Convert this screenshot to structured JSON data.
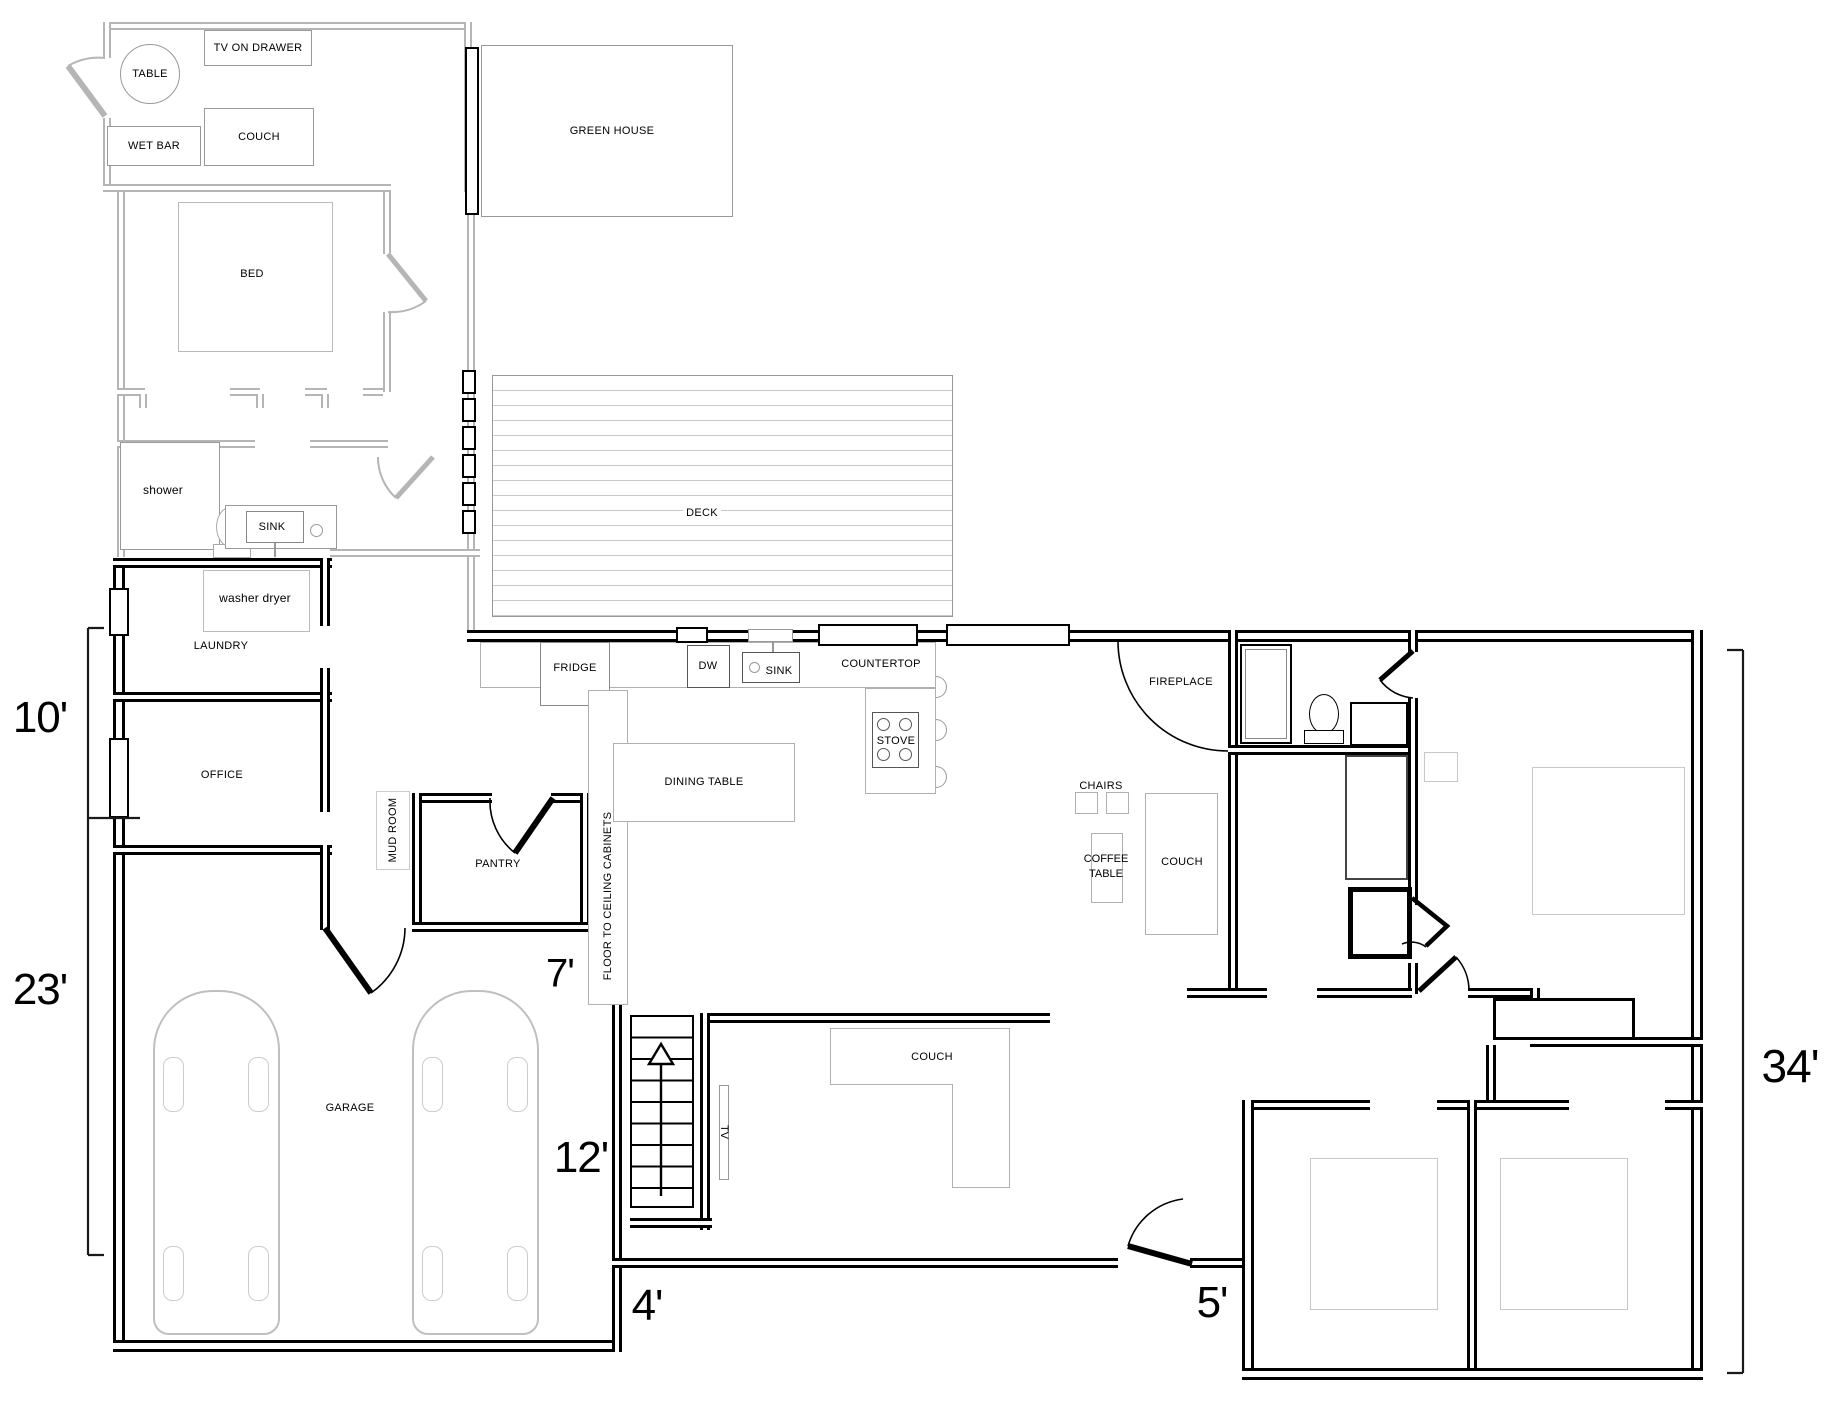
{
  "meta": {
    "type": "architectural floor plan"
  },
  "colors": {
    "wall_black": "#000000",
    "wall_gray": "#b5b5b5",
    "furniture_outline": "#b0b0b0",
    "bed_outline": "#c8c8c8",
    "deck_plank_line": "#c9c9c9",
    "background": "#ffffff"
  },
  "labels": {
    "tv_on_drawer": "TV ON DRAWER",
    "table": "TABLE",
    "wet_bar": "WET BAR",
    "couch_top": "COUCH",
    "green_house": "GREEN HOUSE",
    "bed": "BED",
    "shower": "shower",
    "sink_bath": "SINK",
    "washer_dryer": "washer dryer",
    "laundry": "LAUNDRY",
    "office": "OFFICE",
    "mud_room": "MUD ROOM",
    "pantry": "PANTRY",
    "cabinets": "FLOOR TO CEILING CABINETS",
    "fridge": "FRIDGE",
    "dw": "DW",
    "sink_kitchen": "SINK",
    "countertop": "COUNTERTOP",
    "stove": "STOVE",
    "deck": "DECK",
    "fireplace": "FIREPLACE",
    "chairs": "CHAIRS",
    "coffee_table": "COFFEE TABLE",
    "couch_living": "COUCH",
    "dining_table": "DINING TABLE",
    "garage": "GARAGE",
    "couch_tv": "COUCH",
    "tv": "TV"
  },
  "dimensions": {
    "left_upper": "10'",
    "left_lower": "23'",
    "pantry_depth": "7'",
    "stair_room": "12'",
    "walkway": "4'",
    "entry": "5'",
    "right_height": "34'"
  }
}
